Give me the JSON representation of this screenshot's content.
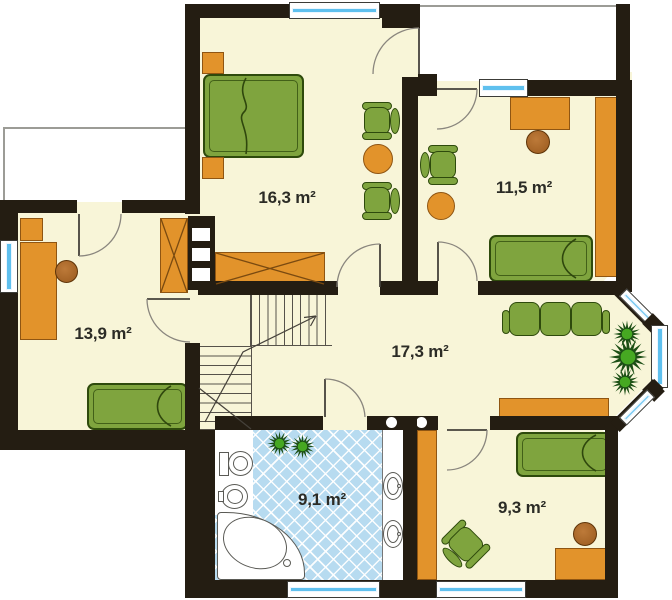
{
  "type": "floor-plan",
  "rooms": [
    {
      "id": "bedroom-top",
      "area_label": "16,3 m²"
    },
    {
      "id": "bedroom-right",
      "area_label": "11,5 m²"
    },
    {
      "id": "bedroom-left",
      "area_label": "13,9 m²"
    },
    {
      "id": "hall",
      "area_label": "17,3 m²"
    },
    {
      "id": "bathroom",
      "area_label": "9,1 m²"
    },
    {
      "id": "bedroom-bottom",
      "area_label": "9,3 m²"
    }
  ],
  "palette": {
    "wall": "#241d12",
    "floor": "#f8f5d8",
    "orange": "#e2932b",
    "orange_border": "#8f5512",
    "green": "#7fa43e",
    "green_border": "#2e4a0c",
    "tile": "#b7dbf0",
    "glass": "#5fc0ee",
    "label": "#2c2c26",
    "rail": "#9c9c96",
    "plant_dark": "#1c4f15",
    "plant_light": "#46a822"
  }
}
